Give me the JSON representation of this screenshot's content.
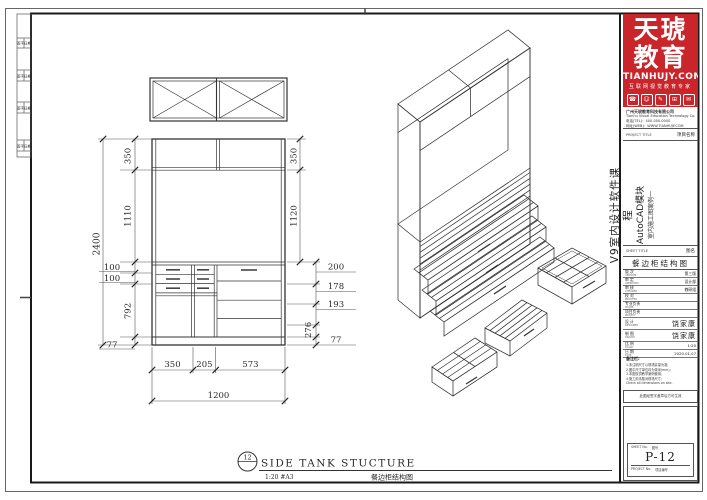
{
  "brand": {
    "name_line1": "天琥",
    "name_line2": "教育",
    "website": "TIANHUJY.COM",
    "tagline": "互联网视觉教育专家",
    "accent_color": "#c9252b",
    "icon_glyphs": [
      "☎",
      "☺",
      "✎",
      "⊞",
      "✉"
    ],
    "icon_names": [
      "phone-icon",
      "person-icon",
      "pen-icon",
      "grid-icon",
      "mail-icon"
    ],
    "company_lines": [
      "广州天琥教育科技有限公司",
      "Tianhu Visual Education Technology Co.,Ltd.",
      "电话(TEL)：400-000-0000",
      "网址(WEB)：WWW.TIANHUJY.COM"
    ]
  },
  "title_block": {
    "project_header_en": "PROJECT TITLE",
    "project_header_cn": "项目名称",
    "project_line1": "V9室内设计软件课程",
    "project_line2": "AutoCAD模块",
    "project_line3": "室内施工图案例一",
    "sheet_header_en": "SHEET TITLE",
    "sheet_header_cn": "图名",
    "sheet_title": "餐边柜结构图",
    "rows": [
      {
        "label": "版 次",
        "en": "VERSION",
        "value": "第三版"
      },
      {
        "label": "审 定",
        "en": "APPROVED",
        "value": "设计部"
      },
      {
        "label": "审 核",
        "en": "CHECKED",
        "value": "教研组"
      },
      {
        "label": "校 对",
        "en": "PROOFED",
        "value": ""
      },
      {
        "label": "专业负责",
        "en": "MAJOR",
        "value": ""
      },
      {
        "label": "项目负责",
        "en": "PROJECT",
        "value": ""
      },
      {
        "label": "设 计",
        "en": "DESIGNED",
        "value": "饶家康"
      },
      {
        "label": "制 图",
        "en": "DRAWN",
        "value": "饶家康"
      },
      {
        "label": "比 例",
        "en": "SCALE",
        "value": "1:20"
      },
      {
        "label": "日 期",
        "en": "DATE",
        "value": "2020.01.07"
      }
    ],
    "notes_title": "备注栏:",
    "notes": [
      "1.未注明尺寸以现场实量为准;",
      "2.图中尺寸单位均为毫米(mm);",
      "3.本图仅供教学案例使用;",
      "4.施工前请核对现场尺寸;",
      "Check all dimensions on site."
    ],
    "stamp_note": "此图经签字盖章后方可生效",
    "sheet_no_label_en": "SHEET No.",
    "sheet_no_label_cn": "图号",
    "sheet_no": "P-12",
    "project_no_label_en": "PROJECT No.",
    "project_no_label_cn": "项目编号"
  },
  "binding_strip": {
    "cells": [
      {
        "a": "签字",
        "b": "日期"
      },
      {
        "a": "签字",
        "b": "日期"
      },
      {
        "a": "签字",
        "b": "日期"
      },
      {
        "a": "签字",
        "b": "日期"
      }
    ]
  },
  "drawing": {
    "callout_number": "12",
    "view_title": "SIDE TANK STUCTURE",
    "view_scale": "1:20 #A3",
    "view_title_cn": "餐边柜结构图",
    "dims": {
      "total_height": "2400",
      "left": [
        "350",
        "1110",
        "100",
        "100",
        "792",
        "77"
      ],
      "right_inner": [
        "350",
        "1120"
      ],
      "right_outer": [
        "200",
        "178",
        "193",
        "276",
        "77"
      ],
      "bottom_segments": [
        "350",
        "205",
        "573"
      ],
      "bottom_total": "1200"
    }
  }
}
